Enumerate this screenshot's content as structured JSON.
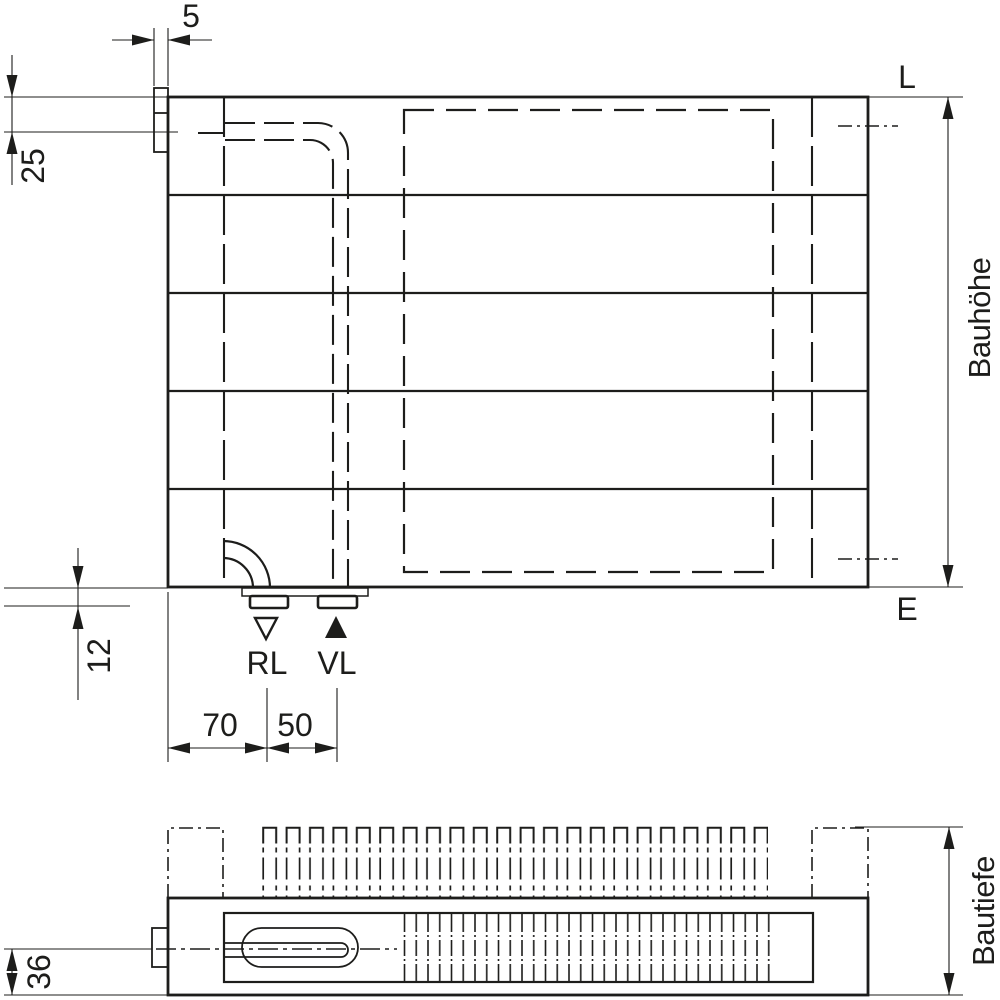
{
  "colors": {
    "ink": "#1d1d1b",
    "paper": "#ffffff"
  },
  "front_view": {
    "dim_tab_width": "5",
    "dim_top_connection": "25",
    "dim_bottom_connection": "12",
    "dim_return_offset": "70",
    "dim_supply_spacing": "50",
    "height_label": "Bauhöhe",
    "marker_top_right": "L",
    "marker_bottom_right": "E",
    "return_label": "RL",
    "supply_label": "VL"
  },
  "plan_view": {
    "dim_pipe_axis": "36",
    "depth_label": "Bautiefe"
  }
}
